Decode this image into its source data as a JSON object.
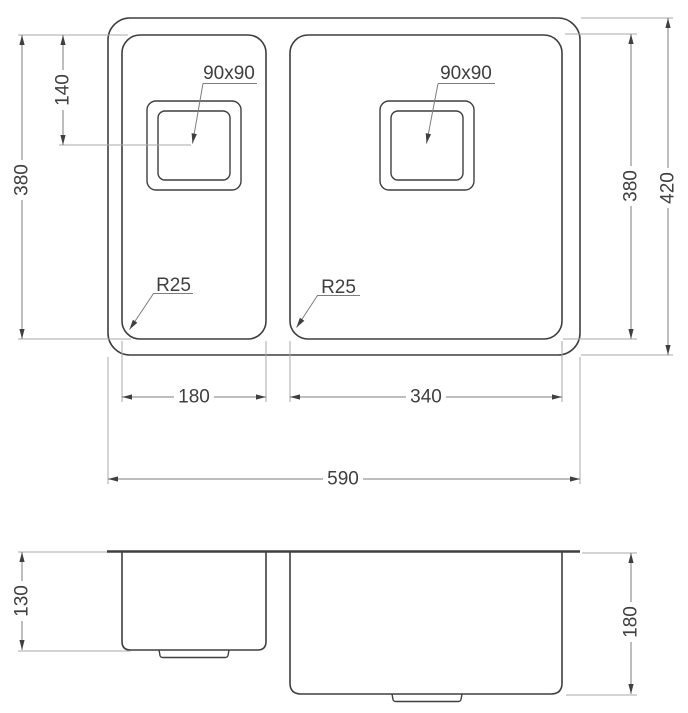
{
  "drawing": {
    "kind": "sink-dimension-diagram",
    "colors": {
      "background": "#ffffff",
      "outline": "#3f3f3f",
      "dimension_line": "#7d7d7d",
      "extension_line": "#a8a8a8",
      "text": "#3f3f3f"
    },
    "top_view": {
      "dimensions": {
        "drain_offset": "140",
        "bowl_depth_left": "380",
        "bowl_depth_right": "380",
        "overall_depth": "420",
        "left_bowl_width": "180",
        "right_bowl_width": "340",
        "overall_width": "590"
      },
      "annotations": {
        "left_drain_size": "90x90",
        "right_drain_size": "90x90",
        "left_corner_radius": "R25",
        "right_corner_radius": "R25"
      }
    },
    "front_view": {
      "dimensions": {
        "left_bowl_depth": "130",
        "right_bowl_depth": "180"
      }
    }
  }
}
